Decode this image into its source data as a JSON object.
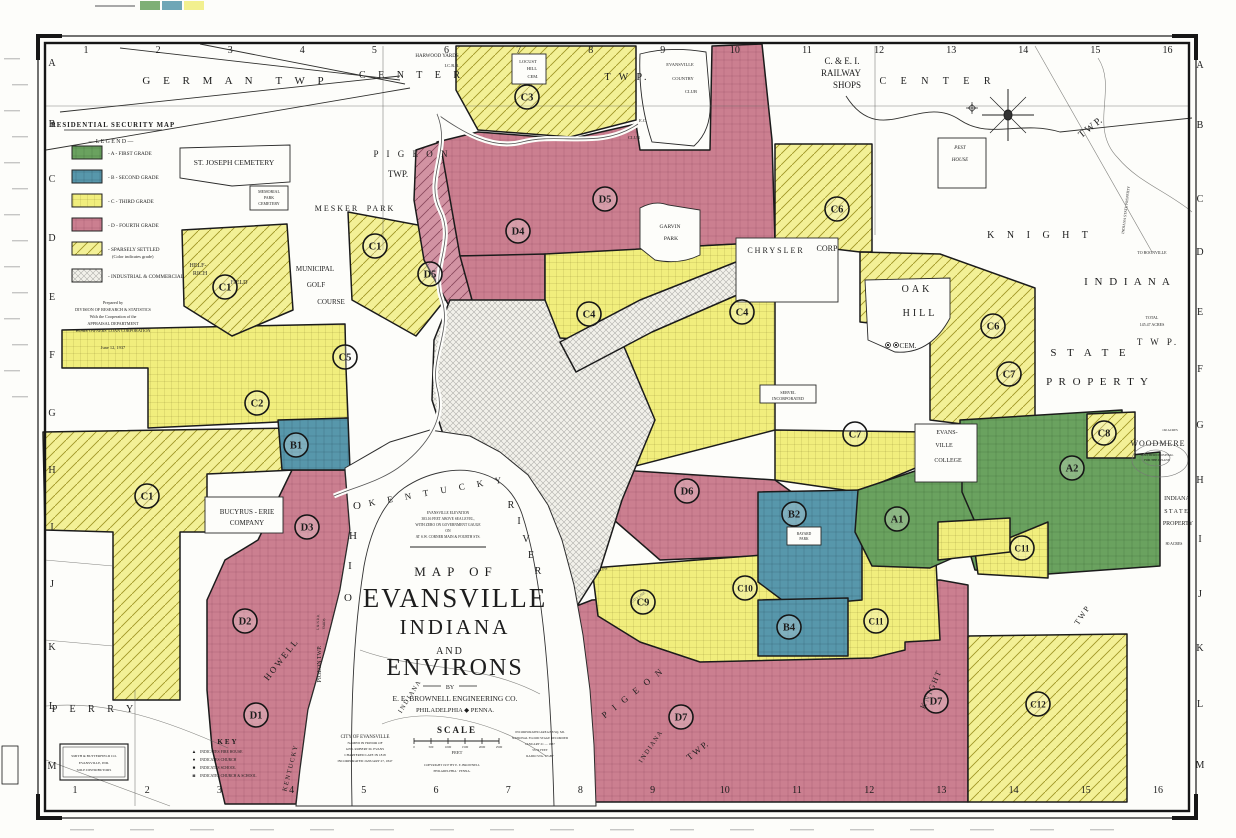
{
  "colors": {
    "grade_a_green": "#6aa25f",
    "grade_b_blue": "#5797ab",
    "grade_c_yellow": "#f1ee7d",
    "grade_d_pink": "#cb7f90",
    "paper": "#fdfdfa",
    "ink": "#1d1d1d"
  },
  "legend": {
    "title": "RESIDENTIAL SECURITY MAP",
    "heading": "— L E G E N D —",
    "items": [
      {
        "grade": "a",
        "label": "- A - FIRST GRADE"
      },
      {
        "grade": "b",
        "label": "- B - SECOND GRADE"
      },
      {
        "grade": "c",
        "label": "- C - THIRD GRADE"
      },
      {
        "grade": "d",
        "label": "- D - FOURTH GRADE"
      },
      {
        "grade": "sparse",
        "label": "- SPARSELY SETTLED",
        "sub": "(Color indicates grade)"
      },
      {
        "grade": "industrial",
        "label": "- INDUSTRIAL & COMMERCIAL"
      }
    ],
    "prepared": [
      "Prepared by",
      "DIVISION OF RESEARCH & STATISTICS",
      "With the Cooperation of the",
      "APPRAISAL DEPARTMENT",
      "HOME OWNERS' LOAN CORPORATION"
    ],
    "date": "June 12, 1937"
  },
  "title_block": {
    "line1": "MAP OF",
    "line2": "EVANSVILLE",
    "line3": "INDIANA",
    "line4": "AND",
    "line5": "ENVIRONS",
    "by": "BY",
    "firm": "E. E. BROWNELL ENGINEERING CO.",
    "firm_city": "PHILADELPHIA ◆ PENNA."
  },
  "scale_block": {
    "title": "SCALE",
    "ticks": [
      "0",
      "500",
      "1000",
      "1500",
      "2000",
      "2500"
    ],
    "unit": "FEET",
    "copyright": [
      "COPYRIGHT 1937 BY E. E. BROWNELL",
      "PHILADELPHIA · PENNA."
    ]
  },
  "city_info": [
    "CITY OF EVANSVILLE",
    "NAMED IN HONOR OF",
    "GEN. ROBERT M. EVANS",
    "CHARTERED LATE IN 1818",
    "INCORPORATED JANUARY 27, 1847"
  ],
  "incorporation_info": [
    "INCORPORATED AREA 8.8 SQ. MI.",
    "NATIONAL FLOOD STAGE RECORDED",
    "JANUARY 21 — 1937",
    "53.74 FEET",
    "RADIO STA. WGBF"
  ],
  "elevation_note": [
    "EVANSVILLE ELEVATION",
    "383.16 FEET ABOVE SEA LEVEL,",
    "WITH ZERO ON GOVERNMENT GAUGE",
    "ON",
    "AT S.W. CORNER MAIN & FOURTH STS."
  ],
  "key": {
    "title": "KEY",
    "items": [
      {
        "sym": "▲",
        "label": "INDICATES FIRE HOUSE"
      },
      {
        "sym": "●",
        "label": "INDICATES CHURCH"
      },
      {
        "sym": "■",
        "label": "INDICATES SCHOOL"
      },
      {
        "sym": "◙",
        "label": "INDICATES CHURCH & SCHOOL"
      }
    ]
  },
  "distributor": [
    "SMITH & BUTTERFIELD CO.",
    "EVANSVILLE, IND.",
    "SOLE DISTRIBUTORS"
  ],
  "grid": {
    "top": [
      "1",
      "2",
      "3",
      "4",
      "5",
      "6",
      "7",
      "8",
      "9",
      "10",
      "11",
      "12",
      "13",
      "14",
      "15",
      "16"
    ],
    "bottom": [
      "1",
      "2",
      "3",
      "4",
      "5",
      "6",
      "7",
      "8",
      "9",
      "10",
      "11",
      "12",
      "13",
      "14",
      "15",
      "16"
    ],
    "left": [
      "A",
      "B",
      "C",
      "D",
      "E",
      "F",
      "G",
      "H",
      "I",
      "J",
      "K",
      "L",
      "M"
    ],
    "right": [
      "A",
      "B",
      "C",
      "D",
      "E",
      "F",
      "G",
      "H",
      "I",
      "J",
      "K",
      "L",
      "M"
    ]
  },
  "zones": [
    {
      "id": "A1",
      "x": 897,
      "y": 519
    },
    {
      "id": "A2",
      "x": 1072,
      "y": 468
    },
    {
      "id": "B1",
      "x": 296,
      "y": 445
    },
    {
      "id": "B2",
      "x": 794,
      "y": 514
    },
    {
      "id": "B4",
      "x": 789,
      "y": 627
    },
    {
      "id": "C1",
      "x": 225,
      "y": 287
    },
    {
      "id": "C1",
      "x": 375,
      "y": 246
    },
    {
      "id": "C1",
      "x": 147,
      "y": 496
    },
    {
      "id": "C2",
      "x": 257,
      "y": 403
    },
    {
      "id": "C3",
      "x": 527,
      "y": 97
    },
    {
      "id": "C4",
      "x": 589,
      "y": 314
    },
    {
      "id": "C4",
      "x": 742,
      "y": 312
    },
    {
      "id": "C5",
      "x": 345,
      "y": 357
    },
    {
      "id": "C6",
      "x": 837,
      "y": 209
    },
    {
      "id": "C6",
      "x": 993,
      "y": 326
    },
    {
      "id": "C7",
      "x": 1009,
      "y": 374
    },
    {
      "id": "C7",
      "x": 855,
      "y": 434
    },
    {
      "id": "C8",
      "x": 1104,
      "y": 433
    },
    {
      "id": "C9",
      "x": 643,
      "y": 602
    },
    {
      "id": "C10",
      "x": 745,
      "y": 588
    },
    {
      "id": "C11",
      "x": 1022,
      "y": 548
    },
    {
      "id": "C11",
      "x": 876,
      "y": 621
    },
    {
      "id": "C12",
      "x": 1038,
      "y": 704
    },
    {
      "id": "D1",
      "x": 256,
      "y": 715
    },
    {
      "id": "D2",
      "x": 245,
      "y": 621
    },
    {
      "id": "D3",
      "x": 307,
      "y": 527
    },
    {
      "id": "D4",
      "x": 518,
      "y": 231
    },
    {
      "id": "D5",
      "x": 605,
      "y": 199
    },
    {
      "id": "D5",
      "x": 430,
      "y": 274
    },
    {
      "id": "D6",
      "x": 687,
      "y": 491
    },
    {
      "id": "D7",
      "x": 681,
      "y": 717
    },
    {
      "id": "D7",
      "x": 936,
      "y": 701
    }
  ],
  "map_labels": [
    {
      "t": "G E R M A N",
      "x": 200,
      "y": 84,
      "s": 11,
      "ls": 5
    },
    {
      "t": "T W P",
      "x": 302,
      "y": 84,
      "s": 11,
      "ls": 5
    },
    {
      "t": "C E N T E R",
      "x": 412,
      "y": 78,
      "s": 10,
      "ls": 5
    },
    {
      "t": "T W P.",
      "x": 627,
      "y": 80,
      "s": 10,
      "ls": 3
    },
    {
      "t": "C E N T E R",
      "x": 938,
      "y": 84,
      "s": 10,
      "ls": 6
    },
    {
      "t": "T W P.",
      "x": 1092,
      "y": 130,
      "s": 10,
      "r": -38
    },
    {
      "t": "HARWOOD  YARDS",
      "x": 437,
      "y": 57,
      "s": 5
    },
    {
      "t": "I.C.R.R.",
      "x": 452,
      "y": 67,
      "s": 4.5
    },
    {
      "t": "LOCUST",
      "x": 528,
      "y": 63,
      "s": 4.5
    },
    {
      "t": "HILL",
      "x": 532,
      "y": 70,
      "s": 4.5
    },
    {
      "t": "CEM.",
      "x": 533,
      "y": 78,
      "s": 4.5
    },
    {
      "t": "EVANSVILLE",
      "x": 680,
      "y": 66,
      "s": 4.5
    },
    {
      "t": "COUNTRY",
      "x": 683,
      "y": 80,
      "s": 4.5
    },
    {
      "t": "CLUB",
      "x": 691,
      "y": 93,
      "s": 4.5
    },
    {
      "t": "E.C.",
      "x": 643,
      "y": 122,
      "s": 4.5
    },
    {
      "t": "CLUB",
      "x": 634,
      "y": 139,
      "s": 4.5
    },
    {
      "t": "C. & E. I.",
      "x": 842,
      "y": 64,
      "s": 9
    },
    {
      "t": "RAILWAY",
      "x": 841,
      "y": 76,
      "s": 9
    },
    {
      "t": "SHOPS",
      "x": 847,
      "y": 88,
      "s": 9
    },
    {
      "t": "PEST",
      "x": 960,
      "y": 149,
      "s": 5,
      "st": "italic"
    },
    {
      "t": "HOUSE",
      "x": 960,
      "y": 161,
      "s": 5,
      "st": "italic"
    },
    {
      "t": "K N I G H T",
      "x": 1040,
      "y": 238,
      "s": 10,
      "ls": 5
    },
    {
      "t": "TO BOONVILLE",
      "x": 1152,
      "y": 254,
      "s": 4
    },
    {
      "t": "I N D I A N A",
      "x": 1128,
      "y": 285,
      "s": 11,
      "ls": 2
    },
    {
      "t": "TOTAL",
      "x": 1152,
      "y": 319,
      "s": 4
    },
    {
      "t": "145.47 ACRES",
      "x": 1152,
      "y": 326,
      "s": 4
    },
    {
      "t": "T W P.",
      "x": 1158,
      "y": 345,
      "s": 9,
      "ls": 3
    },
    {
      "t": "S T A T E",
      "x": 1090,
      "y": 356,
      "s": 11,
      "ls": 4
    },
    {
      "t": "P R O P E R T Y",
      "x": 1098,
      "y": 385,
      "s": 11,
      "ls": 2
    },
    {
      "t": "INDIANA STATE PROPERTY",
      "x": 1127,
      "y": 210,
      "s": 3.8,
      "r": -83
    },
    {
      "t": "WOODMERE",
      "x": 1158,
      "y": 446,
      "s": 8,
      "ls": 1
    },
    {
      "t": "SOUTHERN HOSPITAL",
      "x": 1157,
      "y": 456,
      "s": 3.2
    },
    {
      "t": "FOR THE INSANE",
      "x": 1157,
      "y": 461,
      "s": 3.2
    },
    {
      "t": "160 ACRES",
      "x": 1170,
      "y": 431,
      "s": 3.2
    },
    {
      "t": "INDIANA",
      "x": 1177,
      "y": 500,
      "s": 6
    },
    {
      "t": "S T A T E",
      "x": 1176,
      "y": 513,
      "s": 6
    },
    {
      "t": "PROPERTY",
      "x": 1178,
      "y": 525,
      "s": 6
    },
    {
      "t": "80 ACRES",
      "x": 1174,
      "y": 545,
      "s": 3.8
    },
    {
      "t": "OAK",
      "x": 917,
      "y": 292,
      "s": 10,
      "ls": 3
    },
    {
      "t": "HILL",
      "x": 920,
      "y": 316,
      "s": 10,
      "ls": 3
    },
    {
      "t": "CEM.",
      "x": 908,
      "y": 348,
      "s": 7
    },
    {
      "t": "CHRYSLER",
      "x": 776,
      "y": 253,
      "s": 8,
      "ls": 2
    },
    {
      "t": "CORP",
      "x": 827,
      "y": 251,
      "s": 8
    },
    {
      "t": "GARVIN",
      "x": 670,
      "y": 228,
      "s": 5.5
    },
    {
      "t": "PARK",
      "x": 671,
      "y": 240,
      "s": 5.5
    },
    {
      "t": "EVANS-",
      "x": 947,
      "y": 434,
      "s": 6
    },
    {
      "t": "VILLE",
      "x": 944,
      "y": 447,
      "s": 6
    },
    {
      "t": "COLLEGE",
      "x": 948,
      "y": 462,
      "s": 6
    },
    {
      "t": "BAYARD",
      "x": 804,
      "y": 535,
      "s": 3.6
    },
    {
      "t": "PARK",
      "x": 804,
      "y": 540,
      "s": 3.6
    },
    {
      "t": "SERVEL",
      "x": 788,
      "y": 394,
      "s": 4.2
    },
    {
      "t": "INCORPORATED",
      "x": 788,
      "y": 400,
      "s": 4.2
    },
    {
      "t": "BUCYRUS - ERIE",
      "x": 247,
      "y": 514,
      "s": 7
    },
    {
      "t": "COMPANY",
      "x": 247,
      "y": 525,
      "s": 7
    },
    {
      "t": "ST. JOSEPH CEMETERY",
      "x": 234,
      "y": 165,
      "s": 7.5
    },
    {
      "t": "MEMORIAL",
      "x": 269,
      "y": 193,
      "s": 4
    },
    {
      "t": "PARK",
      "x": 269,
      "y": 199,
      "s": 4
    },
    {
      "t": "CEMETERY",
      "x": 269,
      "y": 205,
      "s": 4
    },
    {
      "t": "MESKER",
      "x": 337,
      "y": 211,
      "s": 8,
      "ls": 2
    },
    {
      "t": "PARK",
      "x": 381,
      "y": 211,
      "s": 8,
      "ls": 2
    },
    {
      "t": "MUNICIPAL",
      "x": 315,
      "y": 271,
      "s": 7
    },
    {
      "t": "GOLF",
      "x": 316,
      "y": 287,
      "s": 7
    },
    {
      "t": "COURSE",
      "x": 331,
      "y": 304,
      "s": 7
    },
    {
      "t": "HELF-",
      "x": 198,
      "y": 267,
      "s": 6
    },
    {
      "t": "RICH",
      "x": 200,
      "y": 275,
      "s": 6
    },
    {
      "t": "FIELD",
      "x": 239,
      "y": 284,
      "s": 6
    },
    {
      "t": "P I G E O N",
      "x": 412,
      "y": 157,
      "s": 9,
      "ls": 3
    },
    {
      "t": "TWP.",
      "x": 398,
      "y": 177,
      "s": 9
    },
    {
      "t": "PIGEON TWP.",
      "x": 321,
      "y": 664,
      "s": 6,
      "r": -90
    },
    {
      "t": "H O W E L L",
      "x": 283,
      "y": 662,
      "s": 9,
      "r": -52
    },
    {
      "t": "K E N T U C K Y",
      "x": 292,
      "y": 769,
      "s": 6.5,
      "r": -76
    },
    {
      "t": "I N D I A N A",
      "x": 411,
      "y": 698,
      "s": 6.5,
      "r": -58
    },
    {
      "t": "P I G E O N",
      "x": 635,
      "y": 695,
      "s": 9,
      "r": -38,
      "ls": 3
    },
    {
      "t": "T W P.",
      "x": 699,
      "y": 753,
      "s": 9,
      "r": -38
    },
    {
      "t": "I N D I A N A",
      "x": 652,
      "y": 748,
      "s": 6.5,
      "r": -56
    },
    {
      "t": "K N I G H T",
      "x": 933,
      "y": 691,
      "s": 8,
      "r": -66
    },
    {
      "t": "T W P",
      "x": 1084,
      "y": 617,
      "s": 8,
      "r": -56
    },
    {
      "t": "P E R R Y",
      "x": 95,
      "y": 712,
      "s": 10,
      "ls": 5
    },
    {
      "t": "K E N T U C K Y",
      "x": 438,
      "y": 494,
      "s": 9,
      "r": -10,
      "ls": 5
    },
    {
      "t": "O",
      "x": 357,
      "y": 509,
      "s": 11
    },
    {
      "t": "H",
      "x": 353,
      "y": 539,
      "s": 11
    },
    {
      "t": "I",
      "x": 350,
      "y": 569,
      "s": 11
    },
    {
      "t": "O",
      "x": 348,
      "y": 601,
      "s": 11
    },
    {
      "t": "R",
      "x": 511,
      "y": 508,
      "s": 10
    },
    {
      "t": "I",
      "x": 519,
      "y": 524,
      "s": 10
    },
    {
      "t": "V",
      "x": 526,
      "y": 542,
      "s": 10
    },
    {
      "t": "E",
      "x": 531,
      "y": 558,
      "s": 10
    },
    {
      "t": "R",
      "x": 538,
      "y": 574,
      "s": 10
    },
    {
      "t": "CITY LINE",
      "x": 600,
      "y": 571,
      "s": 3.4,
      "r": -14
    },
    {
      "t": "CITY LINE",
      "x": 639,
      "y": 598,
      "s": 3.4,
      "r": -36
    },
    {
      "t": "L & N  R.R.",
      "x": 319,
      "y": 622,
      "s": 3.4,
      "r": -88
    },
    {
      "t": "YARDS",
      "x": 325,
      "y": 624,
      "s": 3.4,
      "r": -88
    }
  ]
}
